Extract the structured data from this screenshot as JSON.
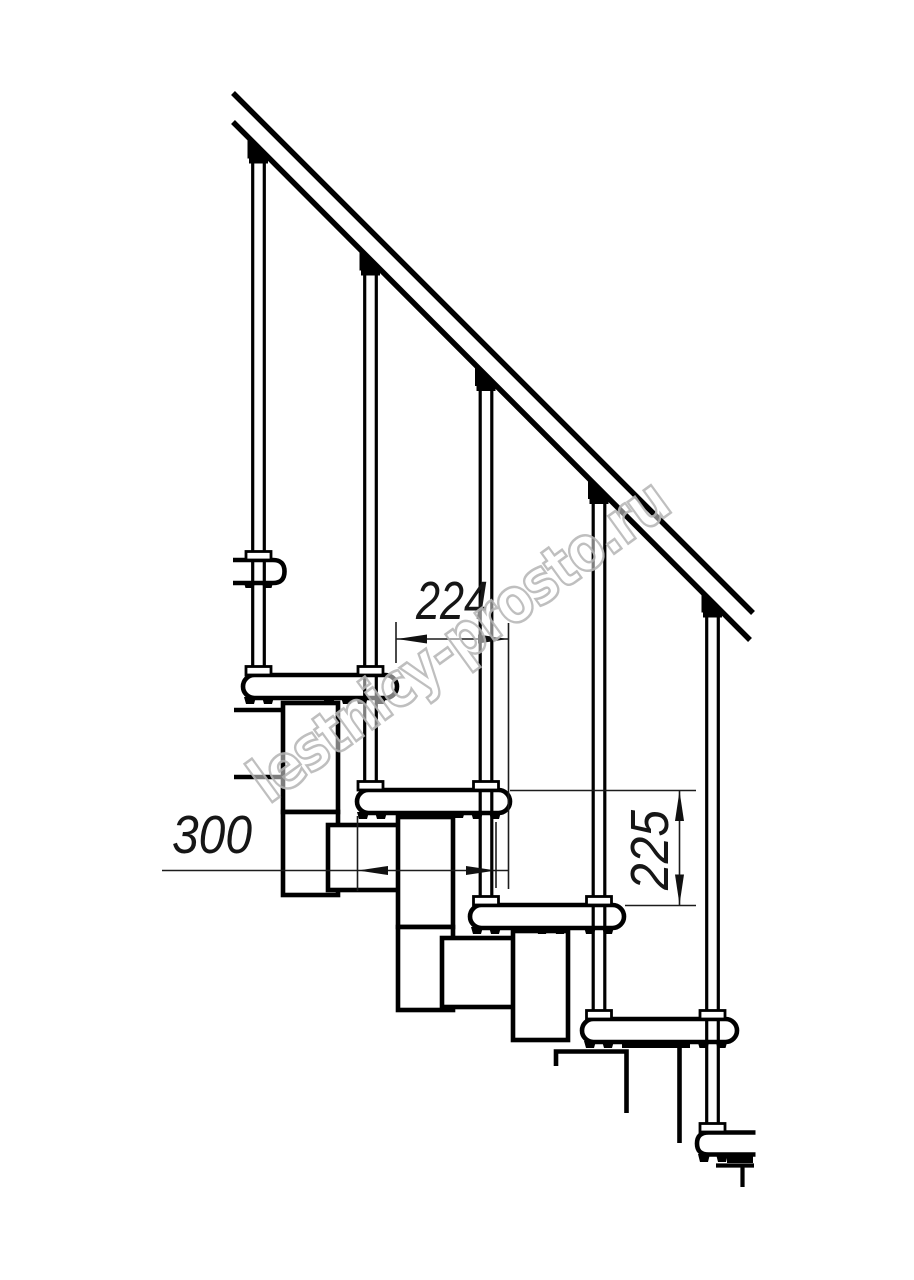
{
  "colors": {
    "background": "#ffffff",
    "ink": "#000000",
    "dimension_ink": "#1c1c1c",
    "watermark_gray": "#b9b9b9"
  },
  "dimensions": {
    "step_run": "224",
    "tread_depth": "300",
    "step_rise": "225"
  },
  "watermark": {
    "text": "lestnicy-prosto.ru"
  }
}
